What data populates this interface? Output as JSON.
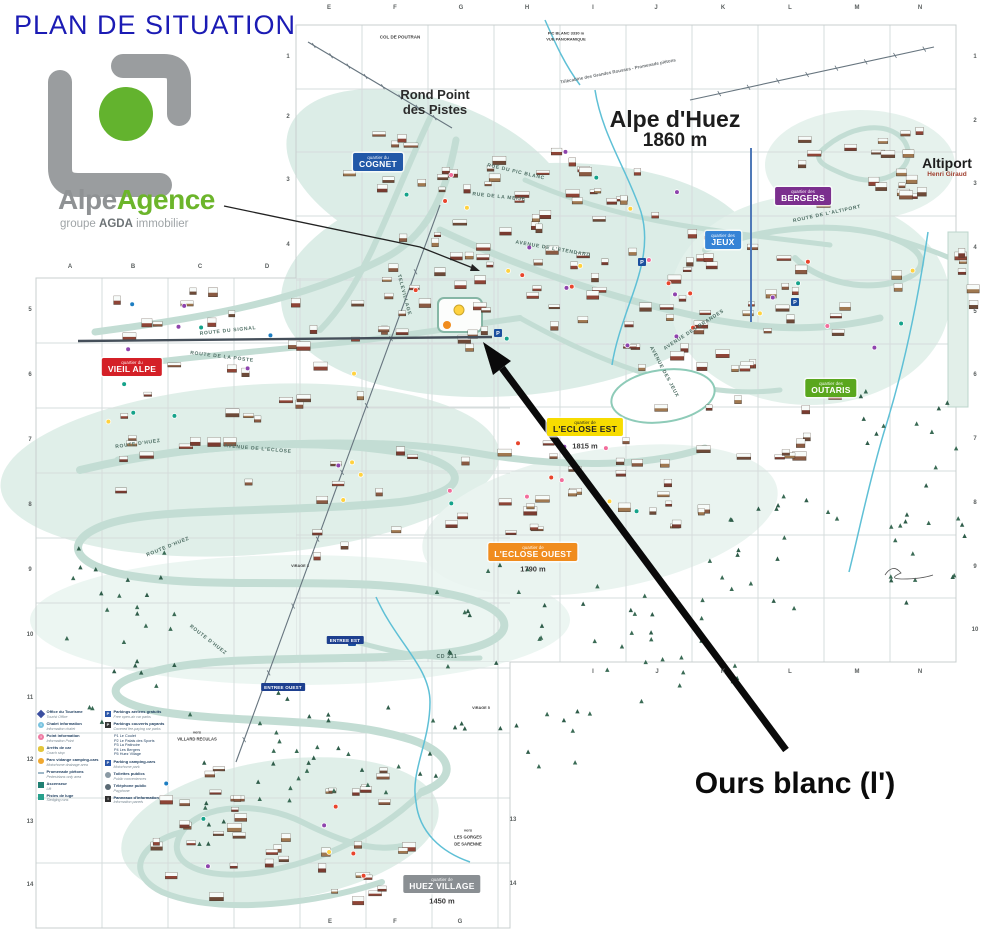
{
  "title": "PLAN DE SITUATION",
  "logo": {
    "name_gray": "Alpe",
    "name_green": "Agence",
    "tagline_pre": "groupe ",
    "tagline_bold": "AGDA",
    "tagline_post": " immobilier"
  },
  "annotation": {
    "label": "Ours blanc (l')"
  },
  "map": {
    "resort": {
      "name": "Alpe d'Huez",
      "altitude": "1860 m"
    },
    "rond_point": {
      "line1": "Rond Point",
      "line2": "des Pistes"
    },
    "altiport": {
      "name": "Altiport",
      "sub": "Henri Giraud"
    },
    "parking_symbol": "P",
    "quarters": [
      {
        "prefix": "quartier du",
        "name": "COGNET",
        "bg": "#2258a8",
        "fg": "#ffffff"
      },
      {
        "prefix": "quartier des",
        "name": "JEUX",
        "bg": "#3583d6",
        "fg": "#ffffff"
      },
      {
        "prefix": "quartier des",
        "name": "BERGERS",
        "bg": "#7b2f8e",
        "fg": "#ffffff"
      },
      {
        "prefix": "quartier du",
        "name": "VIEIL ALPE",
        "bg": "#d42027",
        "fg": "#ffffff"
      },
      {
        "prefix": "quartier des",
        "name": "OUTARIS",
        "bg": "#5aa71e",
        "fg": "#ffffff"
      },
      {
        "prefix": "quartier de",
        "name": "L'ECLOSE EST",
        "bg": "#f7dc00",
        "fg": "#222222",
        "alt": "1815 m"
      },
      {
        "prefix": "quartier de",
        "name": "L'ECLOSE OUEST",
        "bg": "#f08c1e",
        "fg": "#ffffff",
        "alt": "1790 m"
      },
      {
        "prefix": "quartier de",
        "name": "HUEZ VILLAGE",
        "bg": "#8a8f93",
        "fg": "#ffffff",
        "alt": "1450 m"
      }
    ],
    "entrances": [
      {
        "text": "ENTREE EST",
        "x": 345,
        "y": 640
      },
      {
        "text": "ENTREE OUEST",
        "x": 283,
        "y": 687
      }
    ],
    "roads": [
      {
        "text": "ROUTE DU SIGNAL",
        "x": 228,
        "y": 331,
        "rot": -6
      },
      {
        "text": "ROUTE DE LA POSTE",
        "x": 222,
        "y": 357,
        "rot": 7
      },
      {
        "text": "AVENUE DE L'ECLOSE",
        "x": 258,
        "y": 449,
        "rot": 5
      },
      {
        "text": "ROUTE D'HUEZ",
        "x": 138,
        "y": 444,
        "rot": -8
      },
      {
        "text": "ROUTE D'HUEZ",
        "x": 168,
        "y": 547,
        "rot": -22
      },
      {
        "text": "ROUTE D'HUEZ",
        "x": 208,
        "y": 640,
        "rot": 38
      },
      {
        "text": "CD 211",
        "x": 447,
        "y": 657,
        "rot": 0
      },
      {
        "text": "ROUTE DE L'ALTIPORT",
        "x": 827,
        "y": 214,
        "rot": -12
      },
      {
        "text": "AVENUE DES JEUX",
        "x": 664,
        "y": 372,
        "rot": 62
      },
      {
        "text": "RUE DU PIC BLANC",
        "x": 516,
        "y": 172,
        "rot": 13
      },
      {
        "text": "RUE DE LA MEIJE",
        "x": 499,
        "y": 197,
        "rot": 6
      },
      {
        "text": "AVENUE DE L'ETENDARD",
        "x": 553,
        "y": 249,
        "rot": 10
      },
      {
        "text": "AVENUE DES BRANDES",
        "x": 694,
        "y": 330,
        "rot": -33
      },
      {
        "text": "TELEVILLAGE",
        "x": 404,
        "y": 295,
        "rot": 75
      }
    ],
    "places": [
      {
        "text": "COL DE POUTRAN",
        "x": 400,
        "y": 37,
        "size": 4.5
      },
      {
        "text": "PIC BLANC 3330 m",
        "x": 566,
        "y": 33,
        "size": 4
      },
      {
        "text": "VUE PANORAMIQUE",
        "x": 566,
        "y": 39,
        "size": 4
      },
      {
        "text": "Télécabine des Grandes Rousses - Promenade piétons",
        "x": 618,
        "y": 71,
        "size": 4.5,
        "rot": -11,
        "color": "#6a6f72"
      },
      {
        "text": "vers",
        "x": 197,
        "y": 732,
        "size": 4
      },
      {
        "text": "VILLARD RECULAS",
        "x": 197,
        "y": 739,
        "size": 4.2
      },
      {
        "text": "vers",
        "x": 468,
        "y": 830,
        "size": 4
      },
      {
        "text": "LES GORGES",
        "x": 468,
        "y": 837,
        "size": 4.2
      },
      {
        "text": "DE SARENNE",
        "x": 468,
        "y": 844,
        "size": 4.2
      },
      {
        "text": "VIRAGE 5",
        "x": 481,
        "y": 708,
        "size": 3.8
      },
      {
        "text": "VIRAGE 3",
        "x": 300,
        "y": 566,
        "size": 3.8
      }
    ],
    "grid": {
      "top": {
        "labels": [
          "E",
          "F",
          "G",
          "H",
          "I",
          "J",
          "K",
          "L",
          "M",
          "N"
        ],
        "xs": [
          329,
          395,
          461,
          527,
          593,
          656,
          723,
          790,
          857,
          920
        ],
        "y": 8
      },
      "row_letters": {
        "labels": [
          "A",
          "B",
          "C",
          "D"
        ],
        "xs": [
          70,
          133,
          200,
          267
        ],
        "y": 267
      },
      "bottom_left": {
        "labels": [
          "E",
          "F",
          "G"
        ],
        "xs": [
          330,
          395,
          460
        ],
        "y": 922
      },
      "bottom_right": {
        "labels": [
          "I",
          "J",
          "K",
          "L",
          "M",
          "N"
        ],
        "xs": [
          593,
          657,
          723,
          790,
          857,
          920
        ],
        "y": 672
      },
      "left_numbers": {
        "labels": [
          "5",
          "6",
          "7",
          "8",
          "9",
          "10",
          "11",
          "12",
          "13",
          "14"
        ],
        "x": 30,
        "ys": [
          310,
          375,
          440,
          505,
          570,
          635,
          698,
          760,
          822,
          885
        ]
      },
      "inner_numbers": {
        "labels": [
          "1",
          "2",
          "3",
          "4"
        ],
        "x": 288,
        "ys": [
          57,
          117,
          180,
          245
        ]
      },
      "right_numbers": {
        "labels": [
          "1",
          "2",
          "3",
          "4",
          "5",
          "6",
          "7",
          "8",
          "9",
          "10"
        ],
        "x": 975,
        "ys": [
          57,
          121,
          184,
          248,
          312,
          375,
          439,
          503,
          567,
          630
        ]
      },
      "mid_numbers": {
        "labels": [
          "13",
          "14"
        ],
        "x": 513,
        "ys": [
          820,
          884
        ]
      }
    }
  },
  "legend": {
    "columns": [
      {
        "items": [
          {
            "icon": "diamond",
            "color": "#3b4fa0",
            "fr": "Office du Tourisme",
            "en": "Tourist Office"
          },
          {
            "icon": "circle",
            "color": "#79c3e0",
            "glyph": "i",
            "fr": "Chalet information",
            "en": "Information chalet"
          },
          {
            "icon": "circle",
            "color": "#ef7ba3",
            "glyph": "i",
            "fr": "Point information",
            "en": "Information Point"
          },
          {
            "icon": "oval",
            "color": "#e3c63c",
            "fr": "Arrêts de car",
            "en": "Coach stop"
          },
          {
            "icon": "dot",
            "color": "#f0a830",
            "fr": "Parc vidange camping-cars",
            "en": "Motorhome drainage area"
          },
          {
            "icon": "dash",
            "color": "#9fb8c8",
            "fr": "Promenade piétons",
            "en": "Pedestrians only area"
          },
          {
            "icon": "square",
            "color": "#1f7f72",
            "fr": "Ascenseur",
            "en": "Lift"
          },
          {
            "icon": "square",
            "color": "#27a08c",
            "fr": "Pistes de luge",
            "en": "Sledging runs"
          }
        ]
      },
      {
        "items": [
          {
            "icon": "square",
            "color": "#2a56a8",
            "glyph": "P",
            "fr": "Parkings aériens gratuits",
            "en": "Free open-air car parks"
          },
          {
            "icon": "square",
            "color": "#333333",
            "glyph": "P",
            "fr": "Parkings couverts payants",
            "en": "Covered fee-paying car parks"
          },
          {
            "list": [
              "P1 Le Coulet",
              "P2 Le Palais des Sports",
              "P3 La Patinoire",
              "P4 Les Bergers",
              "P5 Huez Village"
            ]
          },
          {
            "icon": "square",
            "color": "#2a56a8",
            "glyph": "P",
            "fr": "Parking camping-cars",
            "en": "Motorhome park"
          },
          {
            "icon": "dot",
            "color": "#8a9aa4",
            "fr": "Toilettes publics",
            "en": "Public conveniences"
          },
          {
            "icon": "dot",
            "color": "#5a6a74",
            "fr": "Téléphone public",
            "en": "Payphone"
          },
          {
            "icon": "square",
            "color": "#2f2f2f",
            "glyph": "i",
            "fr": "Panneaux d'information",
            "en": "Information panels"
          }
        ]
      }
    ]
  }
}
